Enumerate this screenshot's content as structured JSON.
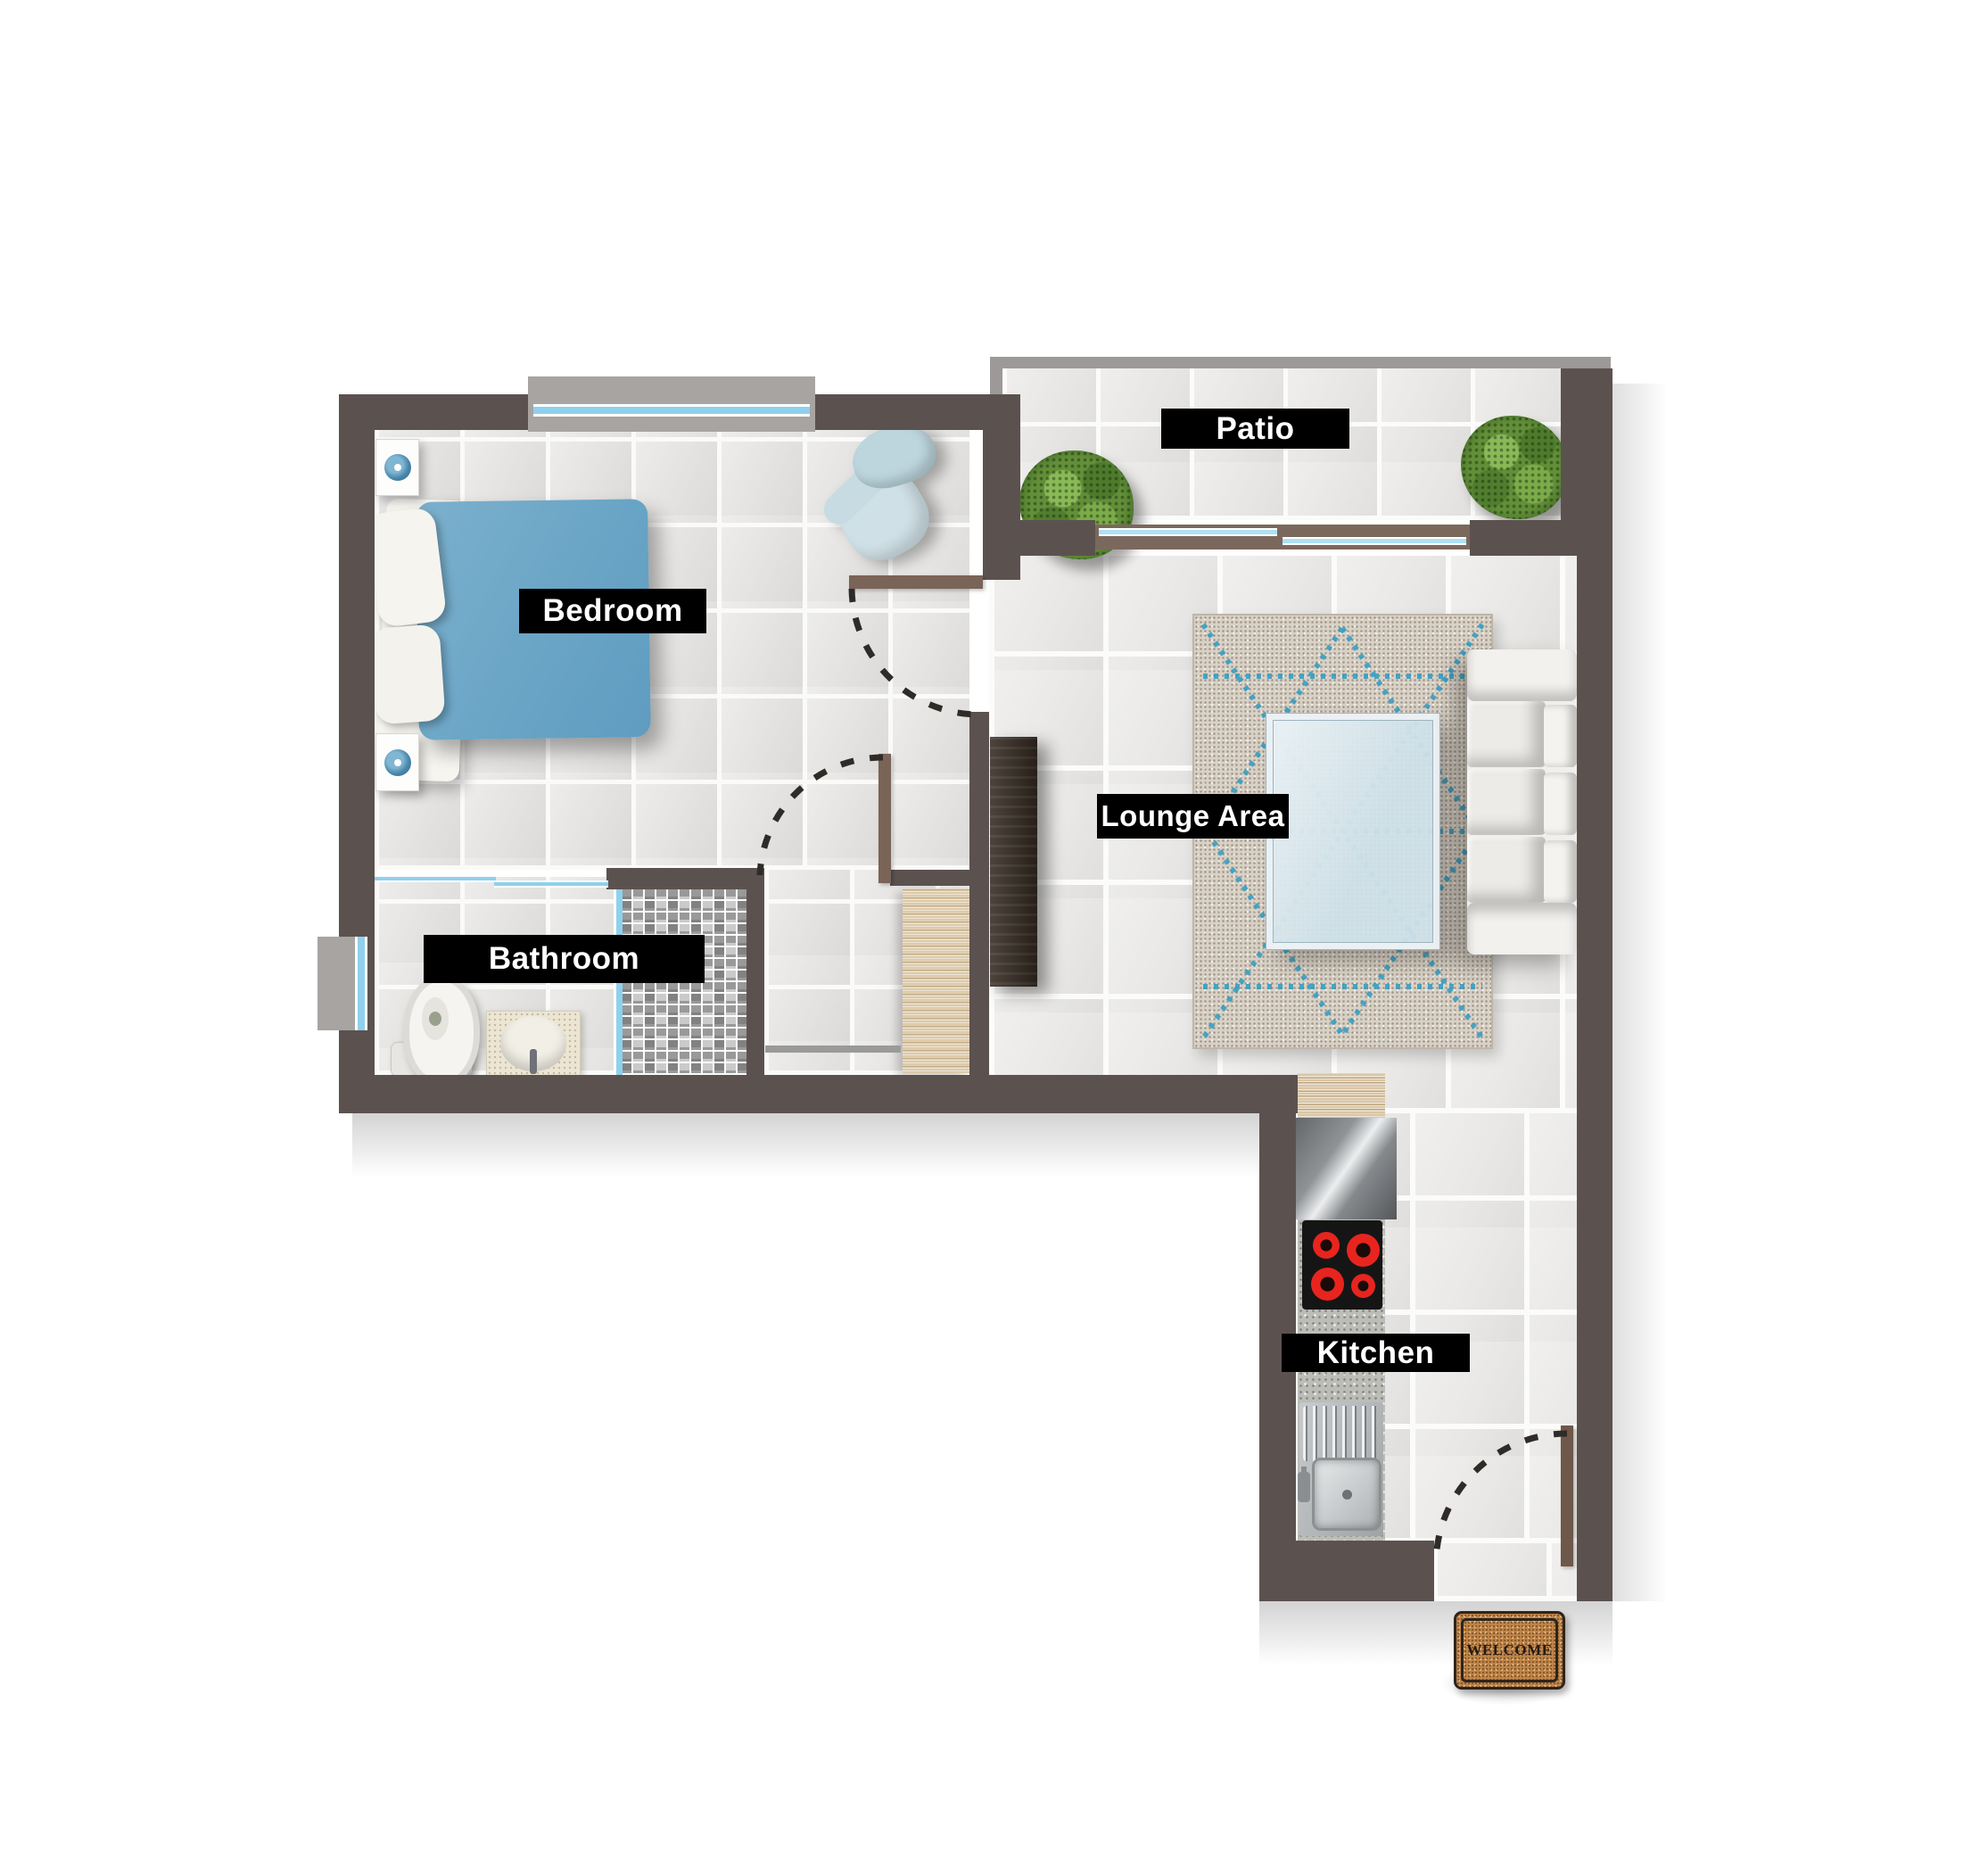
{
  "plan": {
    "type": "apartment-floor-plan",
    "rooms": {
      "bedroom": {
        "label": "Bedroom"
      },
      "bathroom": {
        "label": "Bathroom"
      },
      "lounge": {
        "label": "Lounge Area"
      },
      "patio": {
        "label": "Patio"
      },
      "kitchen": {
        "label": "Kitchen"
      }
    },
    "door_mat": {
      "text": "WELCOME"
    }
  },
  "colors": {
    "wall": "#5b524f",
    "patio_parapet": "#9d9998",
    "floor_tile": "#e5e4e2",
    "grout": "#fafaf9",
    "label_background": "#000000",
    "label_text": "#ffffff",
    "window_glass": "#8fd0ec",
    "door_leaf": "#7a6357",
    "bed_duvet": "#6fa7c7",
    "armchair": "#c5dbe2",
    "sofa": "#f1efec",
    "rug_base": "#d8d1c6",
    "rug_accent": "#2e9cc3",
    "coffee_table_glass": "#cde0e9",
    "plant_foliage": "#628f38",
    "hob_burner": "#e8241f",
    "welcome_mat": "#c08548"
  },
  "furniture_icons": [
    "double-bed",
    "pillow",
    "nightstand",
    "table-lamp",
    "armchair",
    "toilet",
    "washbasin-vanity",
    "shower-enclosure",
    "wardrobe",
    "media-cabinet",
    "area-rug",
    "coffee-table",
    "sofa",
    "potted-plant",
    "kitchen-worktop",
    "hob",
    "kitchen-sink",
    "welcome-mat",
    "hinged-door",
    "sliding-patio-door",
    "window"
  ]
}
